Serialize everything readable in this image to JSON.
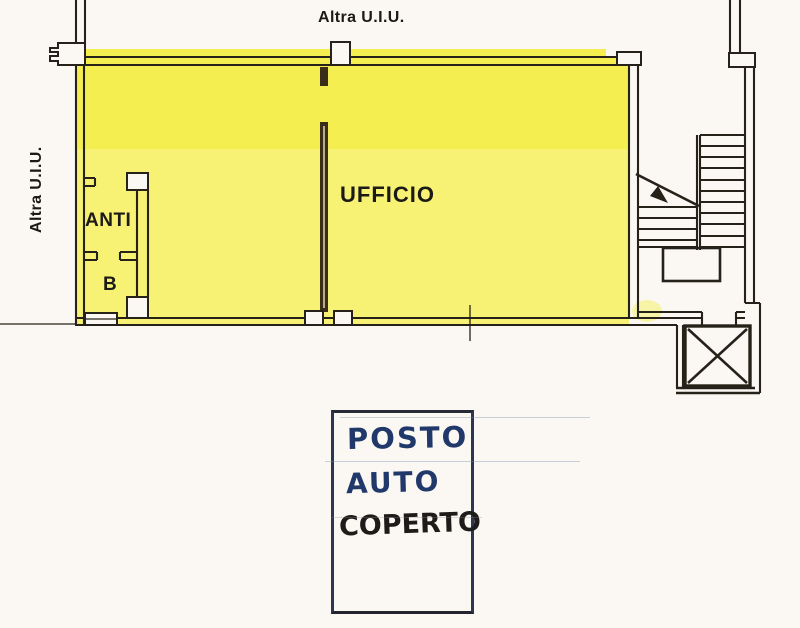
{
  "plan": {
    "labels": {
      "adjacent_unit_top": "Altra U.I.U.",
      "adjacent_unit_left": "Altra U.I.U.",
      "room_anteroom": "ANTI",
      "room_bathroom": "B",
      "room_office": "UFFICIO"
    },
    "colors": {
      "paper": "#fbf8f3",
      "wall": "#262119",
      "partition": "#3a2d1a",
      "highlight": "#f5ee50",
      "highlight_light": "#f7f274",
      "ink_blue": "#21386b",
      "ink_black": "#1e1c1a"
    }
  },
  "annotation": {
    "line1": "POSTO",
    "line2": "AUTO",
    "line3": "COPERTO"
  }
}
